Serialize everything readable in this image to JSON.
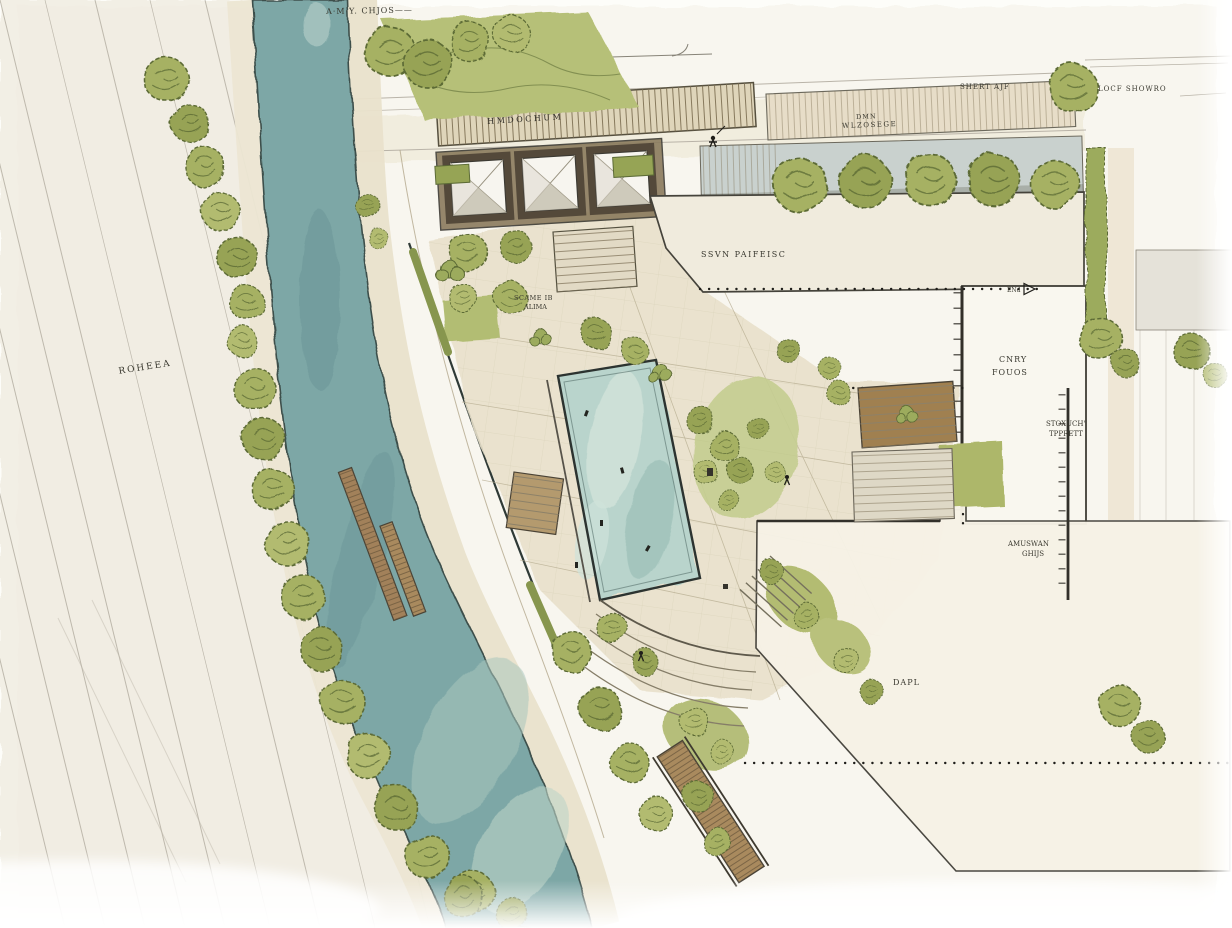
{
  "drawing": {
    "kind_hint": "watercolor landscape site plan sketch",
    "palette": {
      "paper": "#fdfdf9",
      "wash": "#f4f1e7",
      "river": "#7da7a6",
      "pool": "#b9d4cc",
      "foliage": "#a3ae60",
      "foliage_dark": "#5c6b36",
      "lawn": "#b6c078",
      "paving": "#e8e0ca",
      "boardwalk": "#dfd5ba",
      "wood": "#a2815a",
      "building": "#f0ebdd",
      "ink": "#3a392f",
      "pencil": "#a9a396"
    },
    "icons": {
      "tree-icon": "scribbled round canopy",
      "shrub-icon": "clustered small canopies",
      "canopy-pyramid-icon": "white pyramid shade structure",
      "dock-icon": "planked floating dock",
      "person-sketch-icon": "tiny ink figure",
      "arrow-marker-icon": "small open triangle on dotted line"
    }
  },
  "annotations": {
    "sheet_note_top": "A·M·Y. CHJOS——",
    "boardwalk": "HMDOCHUM",
    "plaza_note_line1": "DMN",
    "plaza_note_line2": "WLZOSEGE",
    "street_note_a": "SHERT AJF",
    "street_note_b": "LOCF SHOWRO",
    "north_building": "SSVN PAIFEISC",
    "garden_note_line1": "SCAME IB",
    "garden_note_line2": "ALIMA",
    "east_building_line1": "CNRY",
    "east_building_line2": "FOUOS",
    "east_wall_line1": "STOXUCH'",
    "east_wall_line2": "TPPRETT",
    "southeast_wall_line1": "AMUSWAN",
    "southeast_wall_line2": "GHIJS",
    "south_building": "DAPL",
    "road": "ROHEEA",
    "dimension_note": "ENd"
  }
}
